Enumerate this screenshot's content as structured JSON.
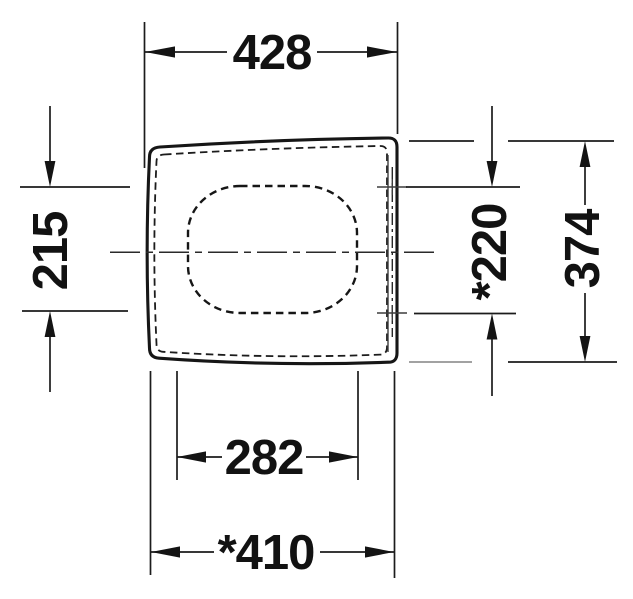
{
  "drawing": {
    "background_color": "#ffffff",
    "line_color": "#1c1c1c",
    "dimensions": {
      "top_width": {
        "label": "428"
      },
      "left_span": {
        "label": "215"
      },
      "hinge_span": {
        "label": "*220"
      },
      "side_depth": {
        "label": "374"
      },
      "inner_bottom_width": {
        "label": "282"
      },
      "bottom_width": {
        "label": "*410"
      }
    }
  }
}
